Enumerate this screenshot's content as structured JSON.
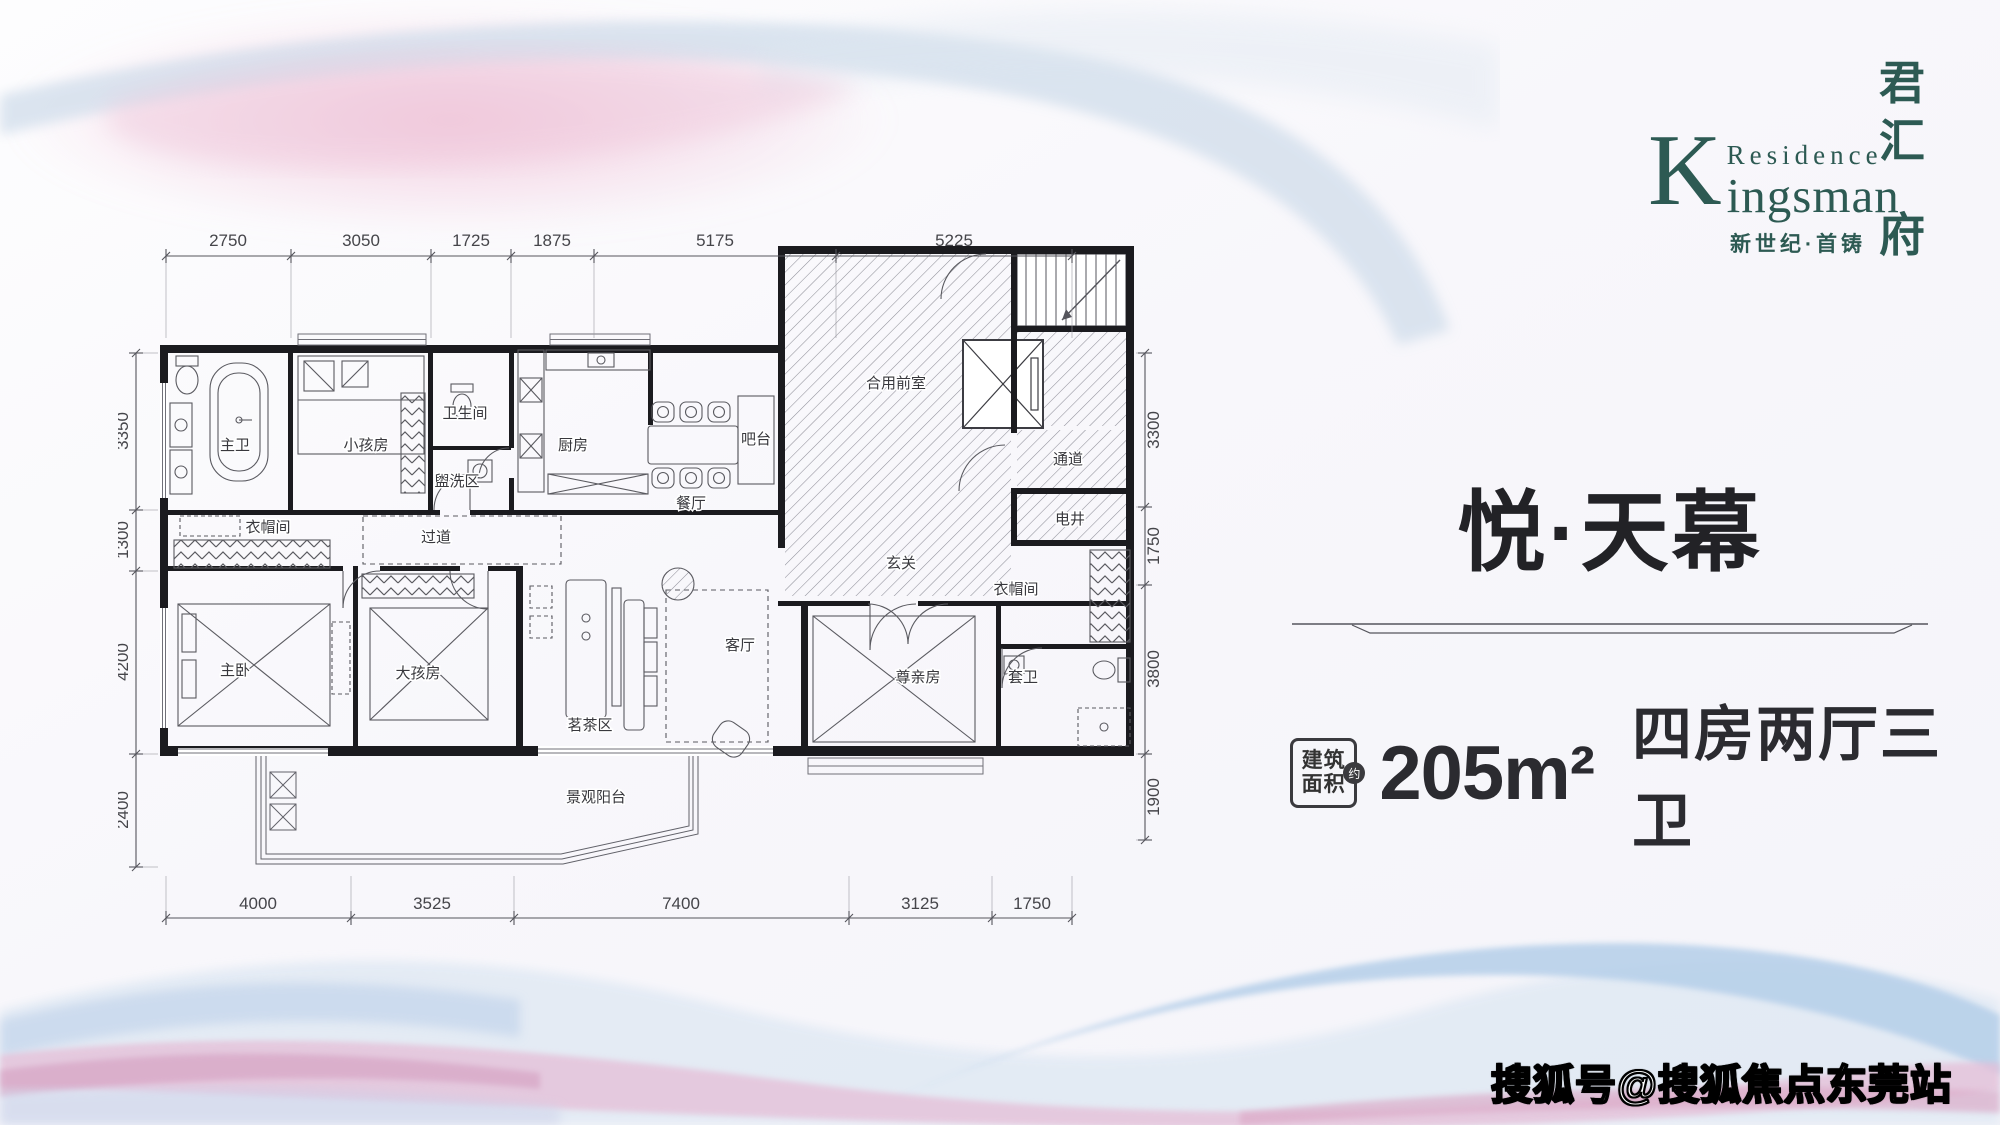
{
  "logo": {
    "k": "K",
    "residence": "Residence",
    "ingsman": "ingsman",
    "tagline": "新世纪·首铸",
    "vertical_name": [
      "君",
      "汇",
      "府"
    ],
    "brand_color": "#2d5a53"
  },
  "panel": {
    "title": "悦·天幕",
    "area_label_1": "建筑",
    "area_label_2": "面积",
    "area_approx": "约",
    "area_value": "205m²",
    "layout": "四房两厅三卫"
  },
  "watermark": {
    "text": "搜狐号@搜狐焦点东莞站"
  },
  "floor_plan": {
    "rooms": [
      {
        "n": "主卫",
        "x": 117,
        "y": 262
      },
      {
        "n": "小孩房",
        "x": 248,
        "y": 262
      },
      {
        "n": "卫生间",
        "x": 347,
        "y": 230
      },
      {
        "n": "盥洗区",
        "x": 339,
        "y": 298
      },
      {
        "n": "厨房",
        "x": 455,
        "y": 262
      },
      {
        "n": "吧台",
        "x": 638,
        "y": 256
      },
      {
        "n": "餐厅",
        "x": 573,
        "y": 320
      },
      {
        "n": "合用前室",
        "x": 778,
        "y": 200
      },
      {
        "n": "通道",
        "x": 950,
        "y": 276
      },
      {
        "n": "电井",
        "x": 952,
        "y": 336
      },
      {
        "n": "玄关",
        "x": 783,
        "y": 380
      },
      {
        "n": "衣帽间",
        "x": 898,
        "y": 406
      },
      {
        "n": "套卫",
        "x": 905,
        "y": 494
      },
      {
        "n": "尊亲房",
        "x": 800,
        "y": 494
      },
      {
        "n": "客厅",
        "x": 622,
        "y": 462
      },
      {
        "n": "茗茶区",
        "x": 472,
        "y": 542
      },
      {
        "n": "过道",
        "x": 318,
        "y": 354
      },
      {
        "n": "衣帽间",
        "x": 150,
        "y": 344
      },
      {
        "n": "主卧",
        "x": 117,
        "y": 487
      },
      {
        "n": "大孩房",
        "x": 300,
        "y": 490
      },
      {
        "n": "景观阳台",
        "x": 478,
        "y": 614
      }
    ],
    "dimensions": {
      "top": {
        "line": {
          "y": 68,
          "x1": 48,
          "x2": 954
        },
        "ticks": [
          48,
          173,
          313,
          393,
          476,
          718,
          954
        ],
        "labels": [
          {
            "t": "2750",
            "x": 110
          },
          {
            "t": "3050",
            "x": 243
          },
          {
            "t": "1725",
            "x": 353
          },
          {
            "t": "1875",
            "x": 434
          },
          {
            "t": "5175",
            "x": 597
          },
          {
            "t": "5225",
            "x": 836
          }
        ]
      },
      "bottom": {
        "line": {
          "y": 730,
          "x1": 48,
          "x2": 954
        },
        "ticks": [
          48,
          233,
          396,
          731,
          874,
          954
        ],
        "labels": [
          {
            "t": "4000",
            "x": 140
          },
          {
            "t": "3525",
            "x": 314
          },
          {
            "t": "7400",
            "x": 563
          },
          {
            "t": "3125",
            "x": 802
          },
          {
            "t": "1750",
            "x": 914
          }
        ]
      },
      "left": {
        "line": {
          "x": 18,
          "y1": 165,
          "y2": 679
        },
        "ticks": [
          165,
          322,
          383,
          566,
          679
        ],
        "labels": [
          {
            "t": "3350",
            "y": 243
          },
          {
            "t": "1300",
            "y": 352
          },
          {
            "t": "4200",
            "y": 474
          },
          {
            "t": "2400",
            "y": 622
          }
        ]
      },
      "right": {
        "line": {
          "x": 1027,
          "y1": 165,
          "y2": 652
        },
        "ticks": [
          165,
          319,
          397,
          566,
          652
        ],
        "labels": [
          {
            "t": "3300",
            "y": 242
          },
          {
            "t": "1750",
            "y": 358
          },
          {
            "t": "3800",
            "y": 481
          },
          {
            "t": "1900",
            "y": 609
          }
        ]
      }
    }
  }
}
